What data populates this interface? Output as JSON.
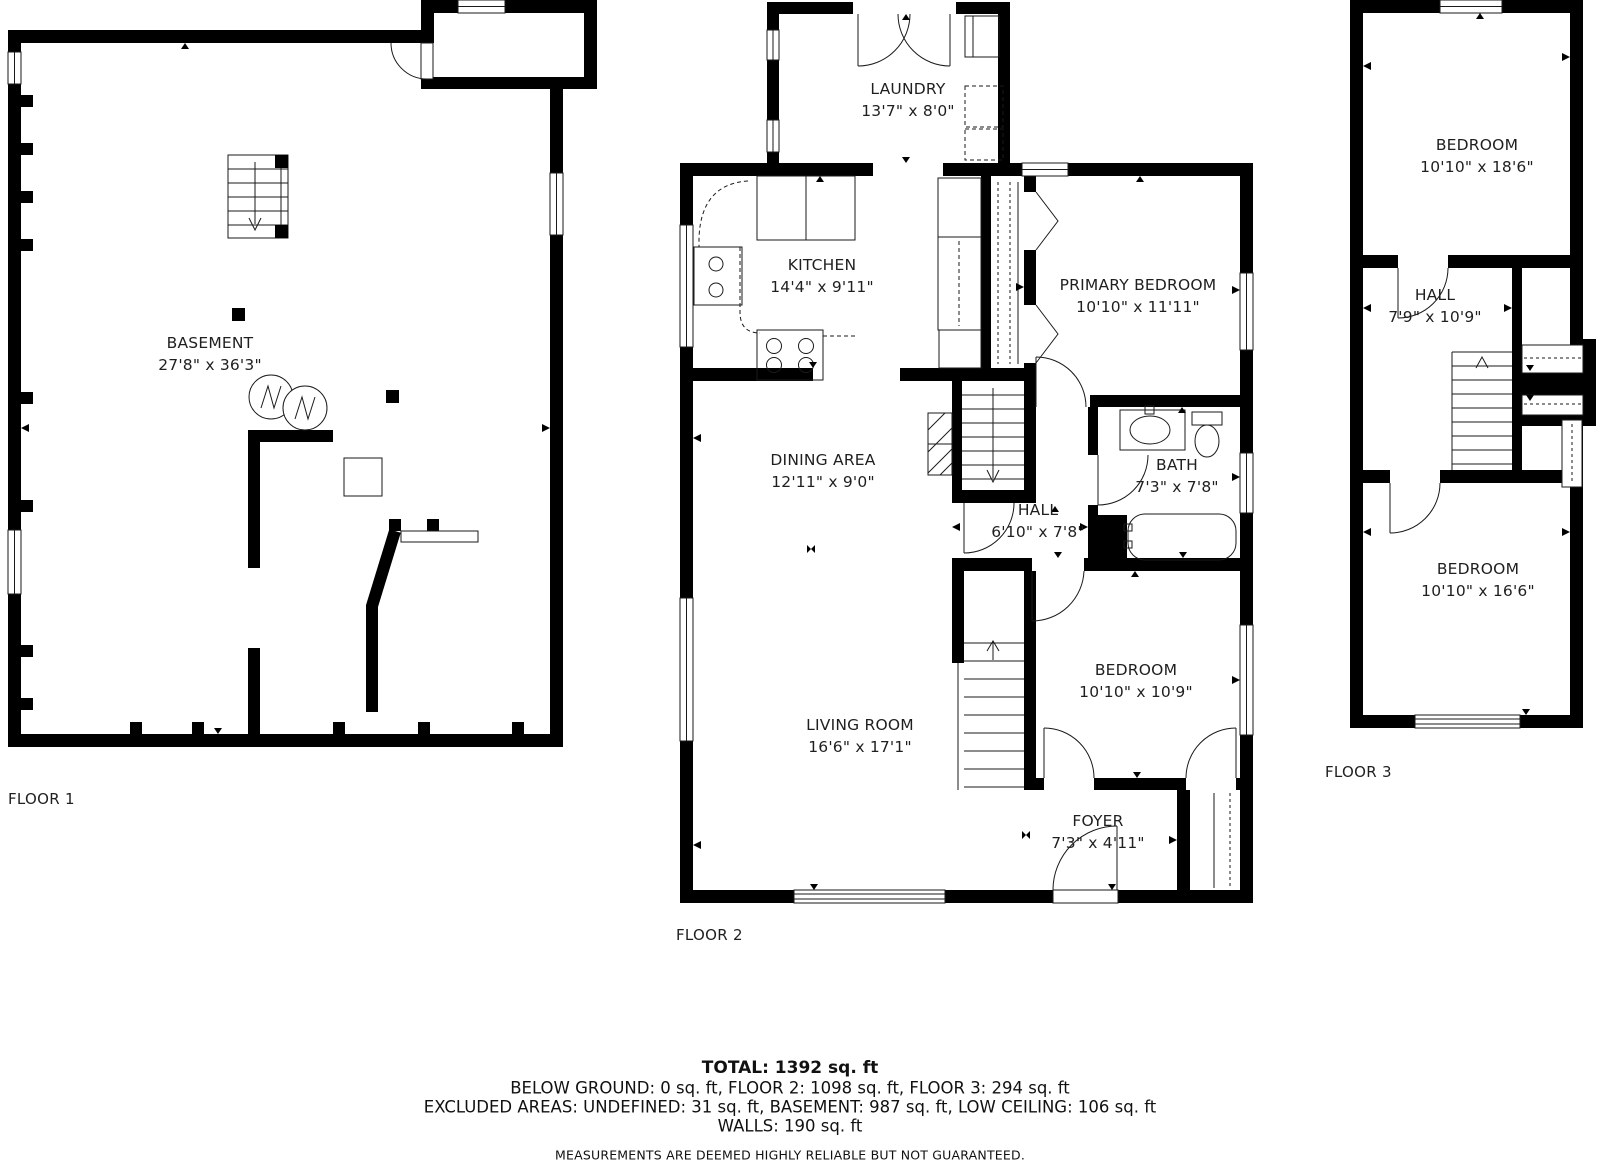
{
  "floors": [
    {
      "label": "FLOOR 1",
      "rooms": [
        {
          "name": "BASEMENT",
          "dims": "27'8\" x 36'3\""
        }
      ]
    },
    {
      "label": "FLOOR 2",
      "rooms": [
        {
          "name": "KITCHEN",
          "dims": "14'4\" x 9'11\""
        },
        {
          "name": "LAUNDRY",
          "dims": "13'7\" x 8'0\""
        },
        {
          "name": "PRIMARY BEDROOM",
          "dims": "10'10\" x 11'11\""
        },
        {
          "name": "DINING AREA",
          "dims": "12'11\" x 9'0\""
        },
        {
          "name": "HALL",
          "dims": "6'10\" x 7'8\""
        },
        {
          "name": "BATH",
          "dims": "7'3\" x 7'8\""
        },
        {
          "name": "BEDROOM",
          "dims": "10'10\" x 10'9\""
        },
        {
          "name": "LIVING ROOM",
          "dims": "16'6\" x 17'1\""
        },
        {
          "name": "FOYER",
          "dims": "7'3\" x 4'11\""
        }
      ]
    },
    {
      "label": "FLOOR 3",
      "rooms": [
        {
          "name": "BEDROOM",
          "dims": "10'10\" x 18'6\""
        },
        {
          "name": "HALL",
          "dims": "7'9\" x 10'9\""
        },
        {
          "name": "BEDROOM",
          "dims": "10'10\" x 16'6\""
        }
      ]
    }
  ],
  "summary": {
    "total": "TOTAL: 1392 sq. ft",
    "floors_line": "BELOW GROUND: 0 sq. ft, FLOOR 2: 1098 sq. ft, FLOOR 3: 294 sq. ft",
    "excluded_line": "EXCLUDED AREAS: UNDEFINED: 31 sq. ft, BASEMENT: 987 sq. ft, LOW CEILING: 106 sq. ft",
    "walls_line": "WALLS: 190 sq. ft",
    "disclaimer": "MEASUREMENTS ARE DEEMED HIGHLY RELIABLE BUT NOT GUARANTEED."
  },
  "colors": {
    "wall": "#000000",
    "background": "#ffffff",
    "text": "#1f1f1f"
  }
}
